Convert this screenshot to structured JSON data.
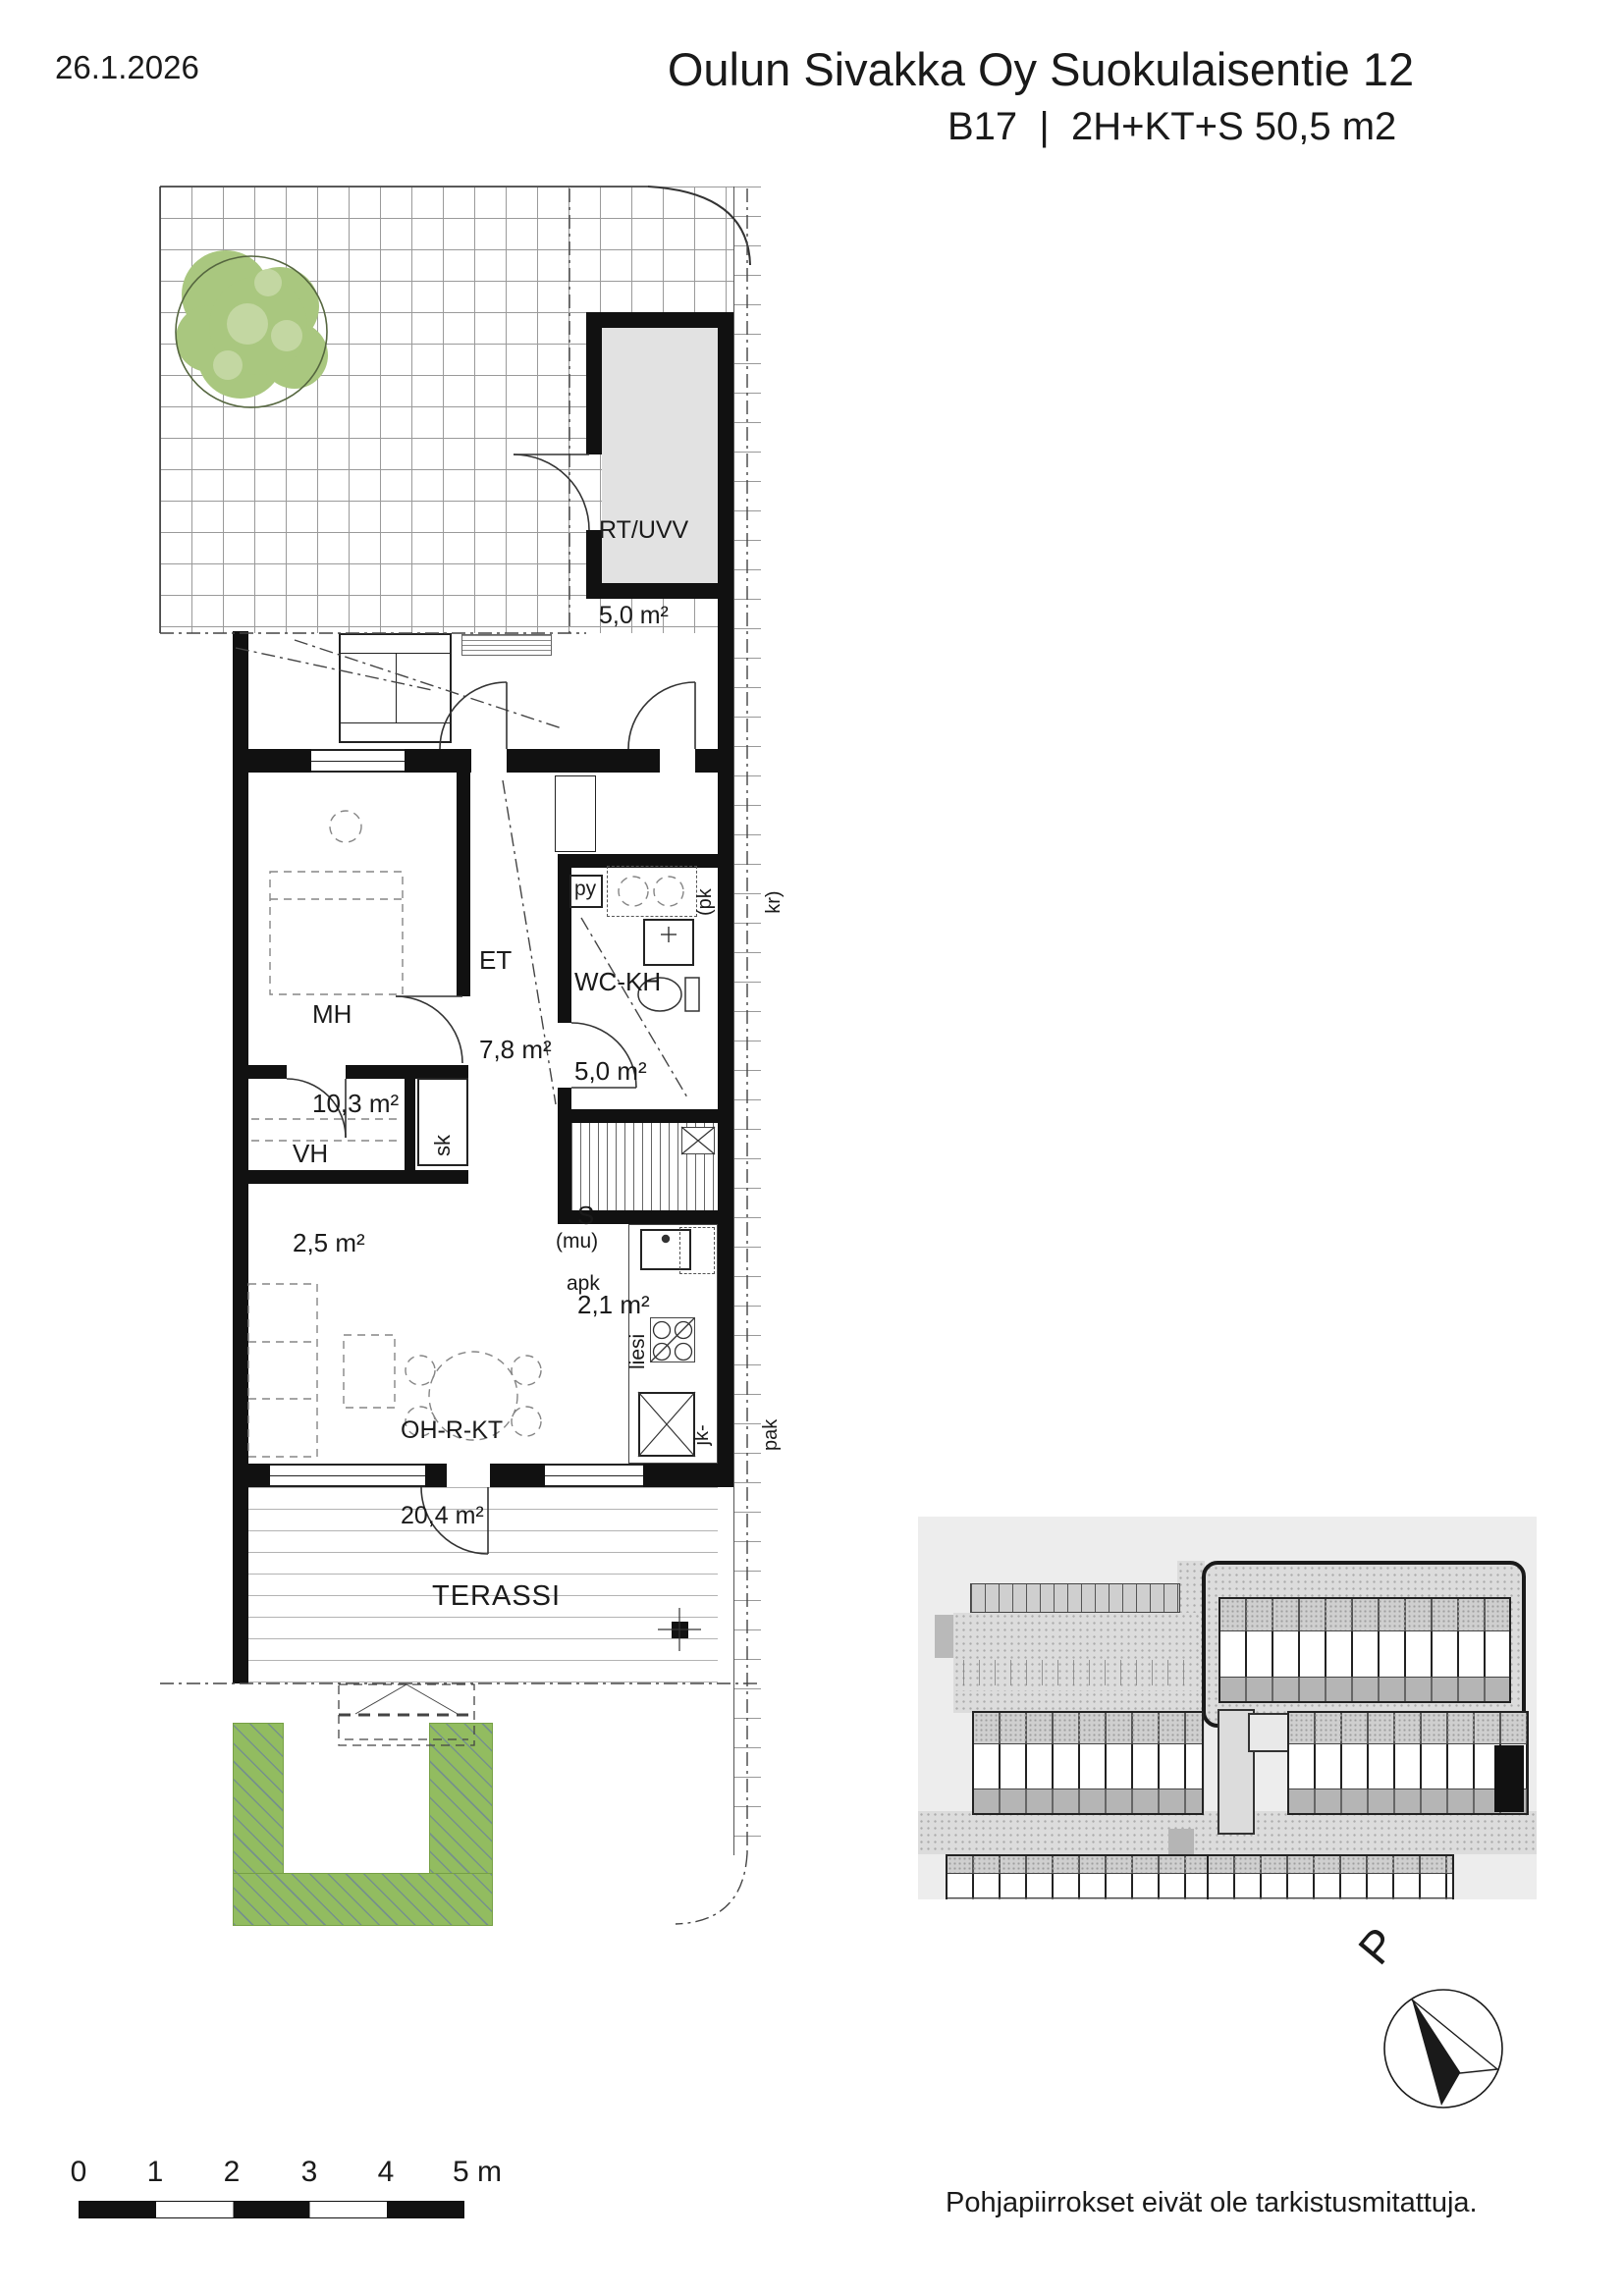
{
  "header": {
    "date": "26.1.2026",
    "title": "Oulun Sivakka Oy Suokulaisentie 12",
    "subtitle": "B17  |  2H+KT+S 50,5 m2"
  },
  "plan": {
    "rooms": {
      "rt_uvv": {
        "name": "RT/UVV",
        "area": "5,0 m²"
      },
      "mh": {
        "name": "MH",
        "area": "10,3 m²"
      },
      "et": {
        "name": "ET",
        "area": "7,8 m²"
      },
      "wc_kh": {
        "name": "WC-KH",
        "area": "5,0 m²"
      },
      "vh": {
        "name": "VH",
        "area": "2,5 m²"
      },
      "sauna": {
        "name": "S",
        "area": "2,1 m²"
      },
      "oh_r_kt": {
        "name": "OH-R-KT",
        "area": "20,4 m²"
      },
      "terassi": {
        "name": "TERASSI"
      }
    },
    "fixtures": {
      "py": "py",
      "pk_kr_line1": "(pk",
      "pk_kr_line2": "kr)",
      "sk": "sk",
      "mu": "(mu)",
      "apk": "apk",
      "liesi": "liesi",
      "jk_pak_line1": "jk-",
      "jk_pak_line2": "pak"
    }
  },
  "scale_bar": {
    "ticks": [
      "0",
      "1",
      "2",
      "3",
      "4",
      "5 m"
    ]
  },
  "north_arrow": {
    "label": "P"
  },
  "footer": {
    "disclaimer": "Pohjapiirrokset eivät ole tarkistusmitattuja."
  },
  "colors": {
    "wall": "#111111",
    "storage_fill": "#e2e2e2",
    "tree_green": "#a9c77f",
    "lawn_green": "#92bc60",
    "site_plan_bg": "#ededed",
    "highlight_unit": "#111111"
  }
}
